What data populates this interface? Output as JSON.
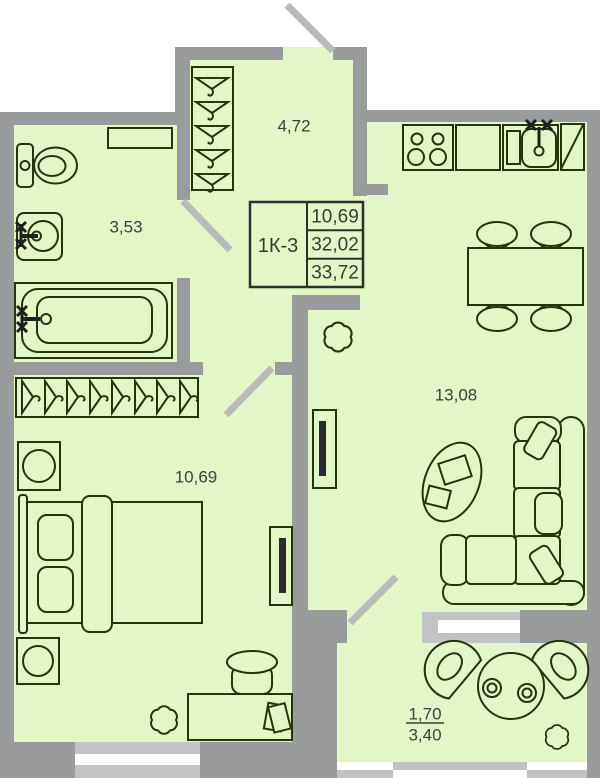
{
  "stamp": {
    "unit": "1К-3",
    "areas": [
      "10,69",
      "32,02",
      "33,72"
    ]
  },
  "rooms": {
    "hallway": {
      "area": "4,72"
    },
    "bathroom": {
      "area": "3,53"
    },
    "bedroom": {
      "area": "10,69"
    },
    "living_room": {
      "area": "13,08"
    },
    "balcony": {
      "area_with_coefficient": "1,70",
      "area_full": "3,40"
    }
  },
  "furniture": {
    "bathroom": [
      "toilet",
      "wall-shelf",
      "washbasin",
      "bathtub"
    ],
    "hallway": [
      "wardrobe-hangers"
    ],
    "bedroom": [
      "wardrobe-hangers",
      "nightstand",
      "double-bed",
      "nightstand",
      "tv",
      "plant",
      "desk",
      "stool"
    ],
    "living_room": [
      "stove",
      "kitchen-counter",
      "kitchen-sink",
      "fridge",
      "dining-table",
      "dining-chairs",
      "corner-sofa",
      "coffee-table",
      "tv",
      "plant"
    ],
    "balcony": [
      "armchair",
      "round-table",
      "cups",
      "armchair",
      "plant"
    ]
  },
  "colors": {
    "floor": "#e3f6c7",
    "wall": "#9a9b9c",
    "door": "#b9babb",
    "winframe": "#c2c3c4",
    "outline": "#27330f",
    "text": "#3f3f3f",
    "screen": "#2b2b2b"
  }
}
